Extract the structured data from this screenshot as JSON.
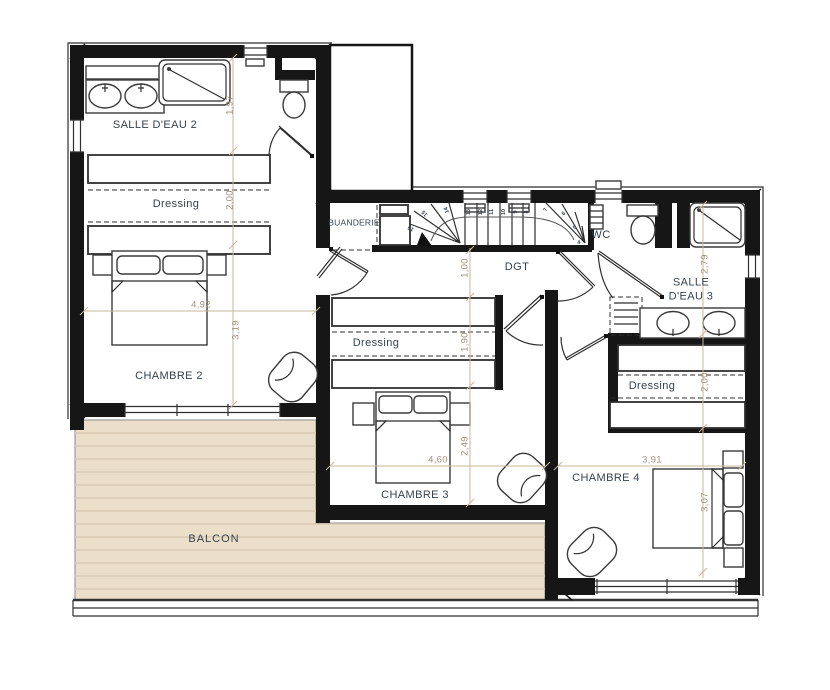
{
  "title": "Floor plan - upper level",
  "colors": {
    "wall": "#161616",
    "thin_line": "#2f2f2f",
    "dimension_line": "#c8b69b",
    "dimension_text": "#a3927c",
    "label_text": "#36424e",
    "balcony_deck": "#ecdfca",
    "balcony_plank_line": "#d9cbb2"
  },
  "rooms": [
    {
      "label": "SALLE D'EAU 2"
    },
    {
      "label": "Dressing"
    },
    {
      "label": "CHAMBRE 2"
    },
    {
      "label": "BUANDERIE"
    },
    {
      "label": "DGT"
    },
    {
      "label": "WC"
    },
    {
      "label": "SALLE\nD'EAU 3"
    },
    {
      "label": "Dressing"
    },
    {
      "label": "CHAMBRE 3"
    },
    {
      "label": "Dressing"
    },
    {
      "label": "CHAMBRE 4"
    },
    {
      "label": "BALCON"
    }
  ],
  "dimensions": [
    {
      "value": "1,97",
      "x": 230,
      "y": 105,
      "rot": -90
    },
    {
      "value": "2,00",
      "x": 230,
      "y": 200,
      "rot": -90
    },
    {
      "value": "3,19",
      "x": 236,
      "y": 330,
      "rot": -90
    },
    {
      "value": "4,92",
      "x": 201,
      "y": 305,
      "rot": 0
    },
    {
      "value": "1,00",
      "x": 465,
      "y": 268,
      "rot": -90
    },
    {
      "value": "1,90",
      "x": 465,
      "y": 342,
      "rot": -90
    },
    {
      "value": "2,49",
      "x": 465,
      "y": 446,
      "rot": -90
    },
    {
      "value": "4,60",
      "x": 438,
      "y": 460,
      "rot": 0
    },
    {
      "value": "2,79",
      "x": 705,
      "y": 264,
      "rot": -90
    },
    {
      "value": "2,00",
      "x": 705,
      "y": 382,
      "rot": -90
    },
    {
      "value": "3,07",
      "x": 705,
      "y": 502,
      "rot": -90
    },
    {
      "value": "3,91",
      "x": 652,
      "y": 460,
      "rot": 0
    }
  ],
  "stairs": {
    "treads": [
      {
        "n": "13",
        "x": 469,
        "y": 212,
        "rot": -90
      },
      {
        "n": "12",
        "x": 481,
        "y": 212,
        "rot": -90
      },
      {
        "n": "11",
        "x": 492,
        "y": 212,
        "rot": -90
      },
      {
        "n": "10",
        "x": 504,
        "y": 212,
        "rot": -90
      },
      {
        "n": "9",
        "x": 516,
        "y": 212,
        "rot": -90
      },
      {
        "n": "8",
        "x": 527,
        "y": 212,
        "rot": -90
      },
      {
        "n": "7",
        "x": 546,
        "y": 210,
        "rot": -65
      },
      {
        "n": "6",
        "x": 564,
        "y": 214,
        "rot": -45
      },
      {
        "n": "5",
        "x": 575,
        "y": 228,
        "rot": -28
      },
      {
        "n": "4",
        "x": 579,
        "y": 243,
        "rot": -10
      },
      {
        "n": "14",
        "x": 447,
        "y": 210,
        "rot": -110
      },
      {
        "n": "15",
        "x": 425,
        "y": 213,
        "rot": -135
      },
      {
        "n": "16",
        "x": 411,
        "y": 228,
        "rot": -155
      }
    ]
  }
}
